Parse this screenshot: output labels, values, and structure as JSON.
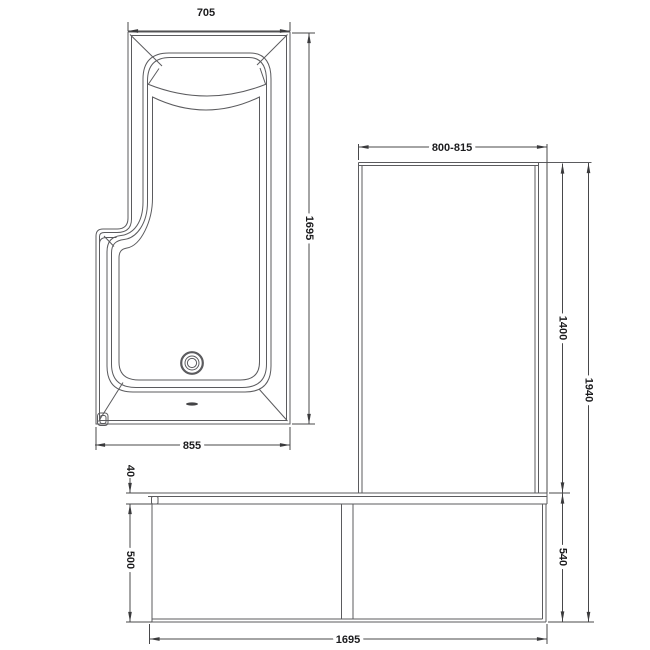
{
  "colors": {
    "line": "#5b5b5e",
    "dim": "#48484a",
    "text": "#1c1c1e",
    "bg": "#ffffff"
  },
  "dims": {
    "plan": {
      "width_top": "705",
      "length": "1695",
      "width_bottom": "855"
    },
    "side": {
      "screen_width": "800-815",
      "screen_height": "1400",
      "total_height": "1940",
      "rim_height": "40",
      "panel_height": "500",
      "end_panel_height": "540",
      "length": "1695"
    }
  }
}
